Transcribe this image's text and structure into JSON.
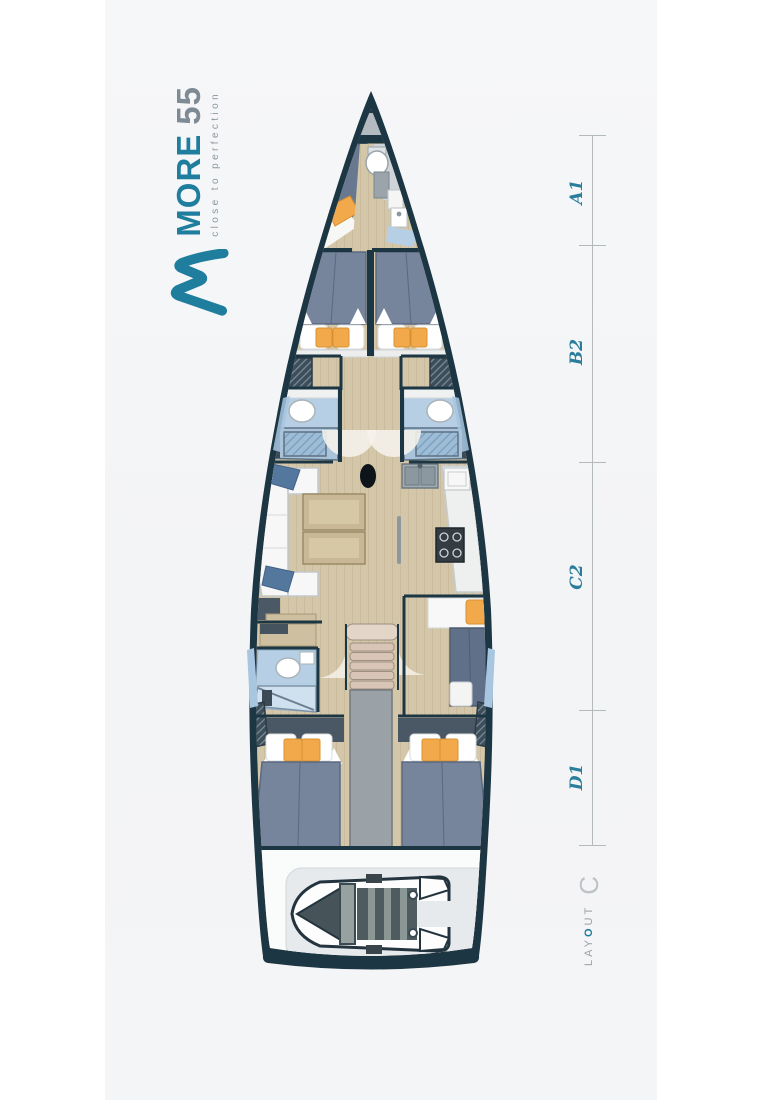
{
  "logo": {
    "brand": "MORE",
    "model": "55",
    "tagline": "close to perfection",
    "mark_icon": "wave-m-icon"
  },
  "scale": {
    "sections": [
      {
        "label": "A1"
      },
      {
        "label": "B2"
      },
      {
        "label": "C2"
      },
      {
        "label": "D1"
      }
    ]
  },
  "layout_badge": {
    "prefix": "LAY",
    "o": "O",
    "suffix": "UT",
    "variant": "C"
  },
  "colors": {
    "accent_teal": "#1f7d9e",
    "model_grey": "#7e8a94",
    "tagline_grey": "#8b98a0",
    "label_teal": "#2a7d9b",
    "scale_line": "#b4b9bc",
    "layout_grey": "#9aa1a6",
    "hull_dark": "#1d3644",
    "floor_tan": "#d4c7a9",
    "mattress_slate": "#76849c",
    "mattress_dark": "#5f7088",
    "cushion_orange": "#f2a94b",
    "pillow_blue": "#54779e",
    "bathroom_blue": "#b7cfe4",
    "corridor_grey": "#9aa2a8",
    "stairs_tan": "#d9c5b6",
    "sofa_white": "#f6f7f6",
    "table_tan": "#c8b896",
    "stove_dark": "#333c42",
    "garage_grey": "#e7eaec",
    "dinghy_floor": "#4f5c5f",
    "panel_bg": "#f4f5f7"
  }
}
